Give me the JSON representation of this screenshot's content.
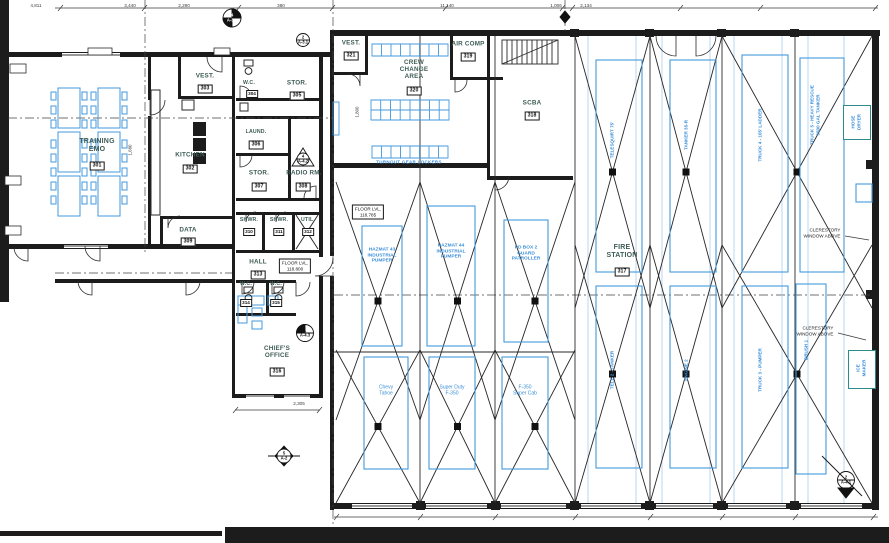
{
  "rooms": {
    "training": {
      "name": "TRAINING\nEMO",
      "number": "301"
    },
    "kitchen": {
      "name": "KITCHEN",
      "number": "302"
    },
    "vest_303": {
      "name": "VEST.",
      "number": "303"
    },
    "wc_304": {
      "name": "W.C.",
      "number": "304"
    },
    "stor_305": {
      "name": "STOR.",
      "number": "305"
    },
    "laundry_306": {
      "name": "LAUND.",
      "number": "306"
    },
    "stor_307": {
      "name": "STOR.",
      "number": "307"
    },
    "radio_308": {
      "name": "RADIO RM.",
      "number": "308"
    },
    "data_309": {
      "name": "DATA",
      "number": "309"
    },
    "shwr_310": {
      "name": "SHWR.",
      "number": "310"
    },
    "shwr_311": {
      "name": "SHWR.",
      "number": "311"
    },
    "util_312": {
      "name": "UTIL.",
      "number": "312"
    },
    "hall_313": {
      "name": "HALL",
      "number": "313"
    },
    "wc_314": {
      "name": "W.C.",
      "number": "314"
    },
    "wc_315": {
      "name": "W.C.",
      "number": "315"
    },
    "chiefs_office": {
      "name": "CHIEF'S\nOFFICE",
      "number": "316"
    },
    "fire_station": {
      "name": "FIRE\nSTATION",
      "number": "317"
    },
    "scba": {
      "name": "SCBA",
      "number": "318"
    },
    "air_comp": {
      "name": "AIR COMP",
      "number": "319"
    },
    "crew_change": {
      "name": "CREW\nCHANGE\nAREA",
      "number": "320"
    },
    "vest_321": {
      "name": "VEST.",
      "number": "321"
    }
  },
  "annotations": {
    "floor_level_hall": "FLOOR LVL.\n118.800",
    "floor_level_bay": "FLOOR LVL.\n118.785",
    "clerestory_1": "CLERESTORY\nWINDOW ABOVE",
    "clerestory_2": "CLERESTORY\nWINDOW ABOVE",
    "locker_caption": "TURNOUT GEAR LOCKERS"
  },
  "vehicles": {
    "mid_1": "HAZMAT 43\nINDUSTRIAL\nPUMPER",
    "mid_2": "HAZMAT 44\nINDUSTRIAL\nPUMPER",
    "mid_3": "PD BOX 2\nGUARD\nPATROLLER",
    "low_1": "Chevy\nTahoe",
    "low_2": "Super Duty\nF-350",
    "low_3": "F-350\nSuper Cab",
    "tall_1": "TELESQUIRT 75'",
    "tall_2": "TANKER 35-R",
    "tall_3": "TRUCK 4 - 105' LADDER",
    "tall_4": "TRUCK 5 - HEAVY RESCUE\n3500 GAL TANKER",
    "tall_low_1": "TELE 2 - TANKER",
    "tall_low_2": "ENGINE 2",
    "tall_low_3": "TRUCK 3 - PUMPER",
    "tall_low_4": "BRUSH 1"
  },
  "equipment": {
    "hose_dryer": "HOSE\nDRYER",
    "ice_maker": "ICE\nMAKER"
  },
  "dimensions": {
    "top": [
      "4,811",
      "3,440",
      "2,290",
      "380",
      "11,140",
      "1,006",
      "2,134"
    ],
    "chief_width": "2,305",
    "locker_depth": "1,800",
    "training_depth": "1,680"
  },
  "markers": {
    "north": "4\nA-3.1",
    "north_small": "2\nA-3.1",
    "radio_section": "4\nA-4.2",
    "chief_section": "1\nA-4.3",
    "south_section": "5\nA-2",
    "corner_section": "2\nA-4.1"
  }
}
